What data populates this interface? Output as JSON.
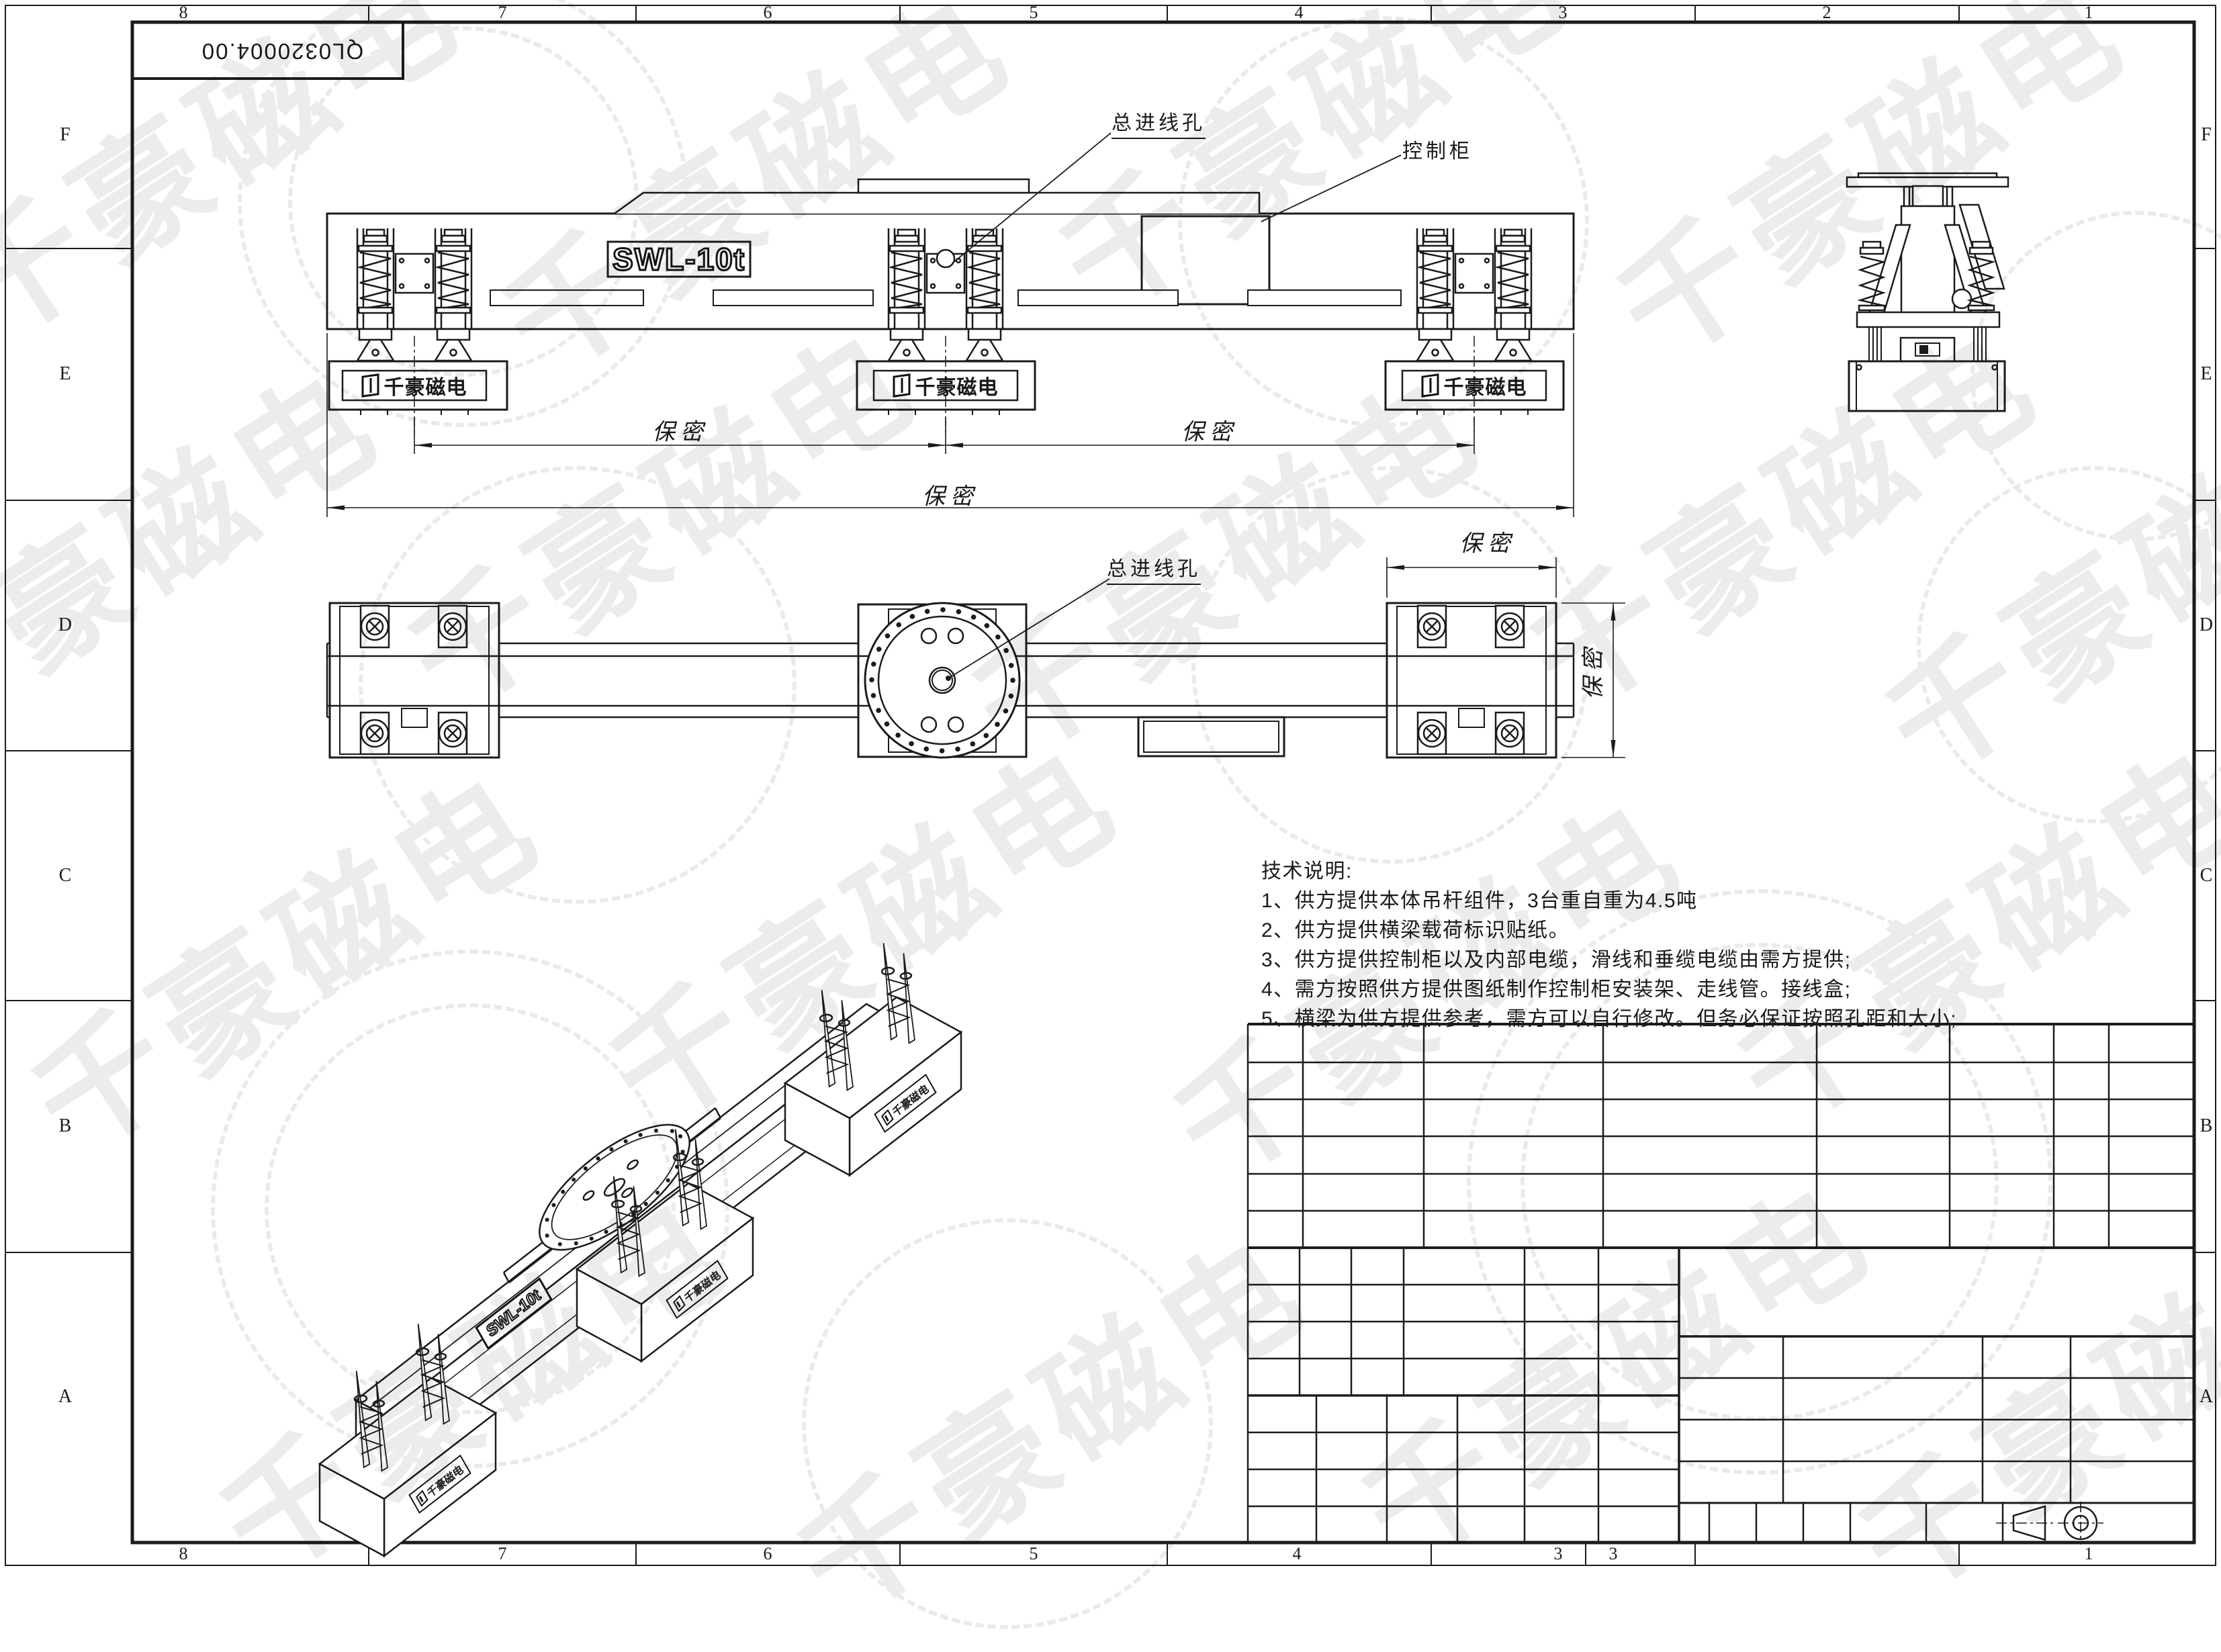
{
  "sheet": {
    "part_number": "QL0320004.00",
    "zones": {
      "letters": [
        "F",
        "E",
        "D",
        "C",
        "B",
        "A"
      ],
      "top_numbers": [
        "8",
        "7",
        "6",
        "5",
        "4",
        "3",
        "2",
        "1"
      ],
      "bottom_numbers": [
        "8",
        "7",
        "6",
        "5",
        "4",
        "3",
        "3",
        "1"
      ]
    }
  },
  "front_view": {
    "swl_label": "SWL-10t",
    "magnet_label": "千豪磁电",
    "inlet_label": "总进线孔",
    "cabinet_label": "控制柜",
    "dim_label": "保密"
  },
  "plan_view": {
    "inlet_label": "总进线孔",
    "dim_label": "保密"
  },
  "iso_view": {
    "swl_label": "SWL-10t",
    "magnet_label": "千豪磁电"
  },
  "tech_notes": {
    "title": "技术说明:",
    "items": [
      "1、供方提供本体吊杆组件，3台重自重为4.5吨",
      "2、供方提供横梁载荷标识贴纸。",
      "3、供方提供控制柜以及内部电缆，滑线和垂缆电缆由需方提供;",
      "4、需方按照供方提供图纸制作控制柜安装架、走线管。接线盒;",
      "5、横梁为供方提供参考，需方可以自行修改。但务必保证按照孔距和大小;"
    ]
  },
  "watermark": {
    "text": "千豪磁电",
    "color": "#ececec",
    "texts": [
      [
        300,
        210
      ],
      [
        1120,
        260
      ],
      [
        1950,
        170
      ],
      [
        2780,
        240
      ],
      [
        180,
        820
      ],
      [
        980,
        760
      ],
      [
        1820,
        830
      ],
      [
        2650,
        760
      ],
      [
        3180,
        860
      ],
      [
        420,
        1420
      ],
      [
        1280,
        1380
      ],
      [
        2120,
        1460
      ],
      [
        2960,
        1380
      ],
      [
        700,
        2050
      ],
      [
        1560,
        2110
      ],
      [
        2400,
        2030
      ],
      [
        3140,
        2080
      ]
    ],
    "circles": [
      [
        690,
        300,
        330
      ],
      [
        690,
        300,
        255
      ],
      [
        2060,
        330,
        300
      ],
      [
        860,
        1020,
        320
      ],
      [
        2070,
        990,
        290
      ],
      [
        3120,
        960,
        260
      ],
      [
        700,
        1800,
        380
      ],
      [
        700,
        1800,
        300
      ],
      [
        1500,
        2120,
        300
      ],
      [
        2620,
        1760,
        430
      ],
      [
        2620,
        1760,
        350
      ],
      [
        3180,
        560,
        240
      ]
    ]
  }
}
